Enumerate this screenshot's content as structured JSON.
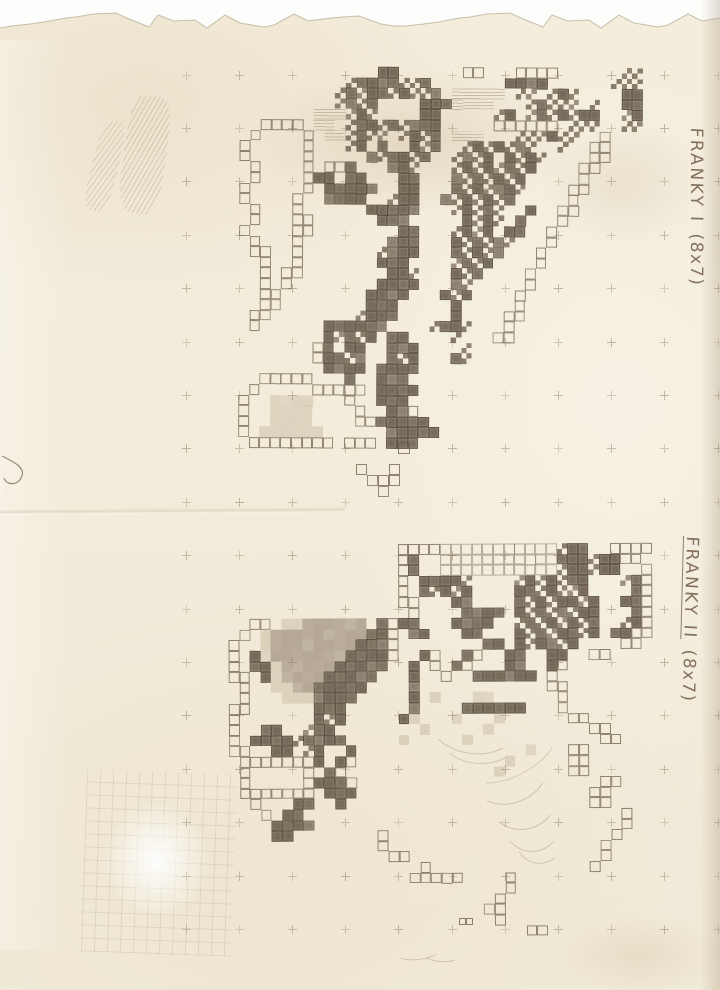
{
  "labels": {
    "franky1": {
      "text_name": "FRANKY I",
      "text_size": "(8x7)",
      "underlined": false
    },
    "franky2": {
      "text_name": "FRANKY II",
      "text_size": "(8x7)",
      "underlined": true
    }
  },
  "palette": {
    "paper": "#f3ecda",
    "pencil_dark": "#5a4d3d",
    "pencil_mid": "#8a7a66",
    "pencil_light": "#b8a88f",
    "grid_cross": "#9a8c74",
    "background": "#fdfdfb"
  },
  "grid": {
    "x0": 186,
    "y0": 75,
    "dx": 53.2,
    "dy": 53.4,
    "cols": 11,
    "rows": 17
  },
  "sprites": [
    {
      "id": "franky1",
      "x": 240,
      "y": 66,
      "cell": 10.6,
      "rows": [
        ".............##......oo...oooo......**..",
        "..........*####**#.......####......***..",
        ".........*#*##*#**#.hhhhh.**.*#*....##..",
        ".........*#*#....###hhhh...*#***.*..##..",
        ".......hhh*#*....##.....*#.*#*#*##..*#..",
        "..oooo.hh.*##*#*###.....oooooo.***..**..",
        ".o....o.hh*#**.*#*#.hhh...***#**..o.....",
        "o.....o...*#.#..#*#..*#*#*#*..*..oo.....",
        "o.....o.....#*##*#..*#*#.#*#*....oo.....",
        ".o....o.oo#...##*...*#*#*#*#....oo......",
        ".o....o##.##...##...#*#*#*#.....o.......",
        "o.....o.#####..##...#*#*##*....oo.......",
        "o....o..####..*##..#*#*#*#.....o........",
        ".o...o......#####...*#*#*..#..oo........",
        ".o...oo......###.....#*#*.#...o.........",
        "o....oo........##...*#*#.##..o..........",
        ".o...o........###...#*#*#*...o..........",
        ".oo..o.......*###...#*#*#...o...........",
        "..o..o.......###....*#*#....o...........",
        "..o.oo........##*...#*#....o............",
        "..o.o........####...#*.....o............",
        "..oo........####...#*#....o.............",
        "..oo........###.....#.....o.............",
        ".oo........*###.....#....oo.............",
        ".o......######....*##*...o..............",
        "........#*#*#.##....*...oo..............",
        ".......o#.##..###....*..................",
        ".......o##*#..#*#...#*..................",
        "........####.####.......................",
        "..ooooo...#..###........................",
        ".o.....ooooo.####.......................",
        "o..ssss...o..###........................",
        "o..ssss....o..##o.......................",
        "o..ssss....oo#####......................",
        "o.ssssss......#####.....................",
        ".oooooooo.ooo.###......................."
      ]
    },
    {
      "id": "franky2",
      "x": 228,
      "y": 545,
      "cell": 10.6,
      "rows": [
        "................ooooxxxxxxxxxxx*##..oooo",
        "................o#..xxxxxxxxxxx###*##oo.",
        "................o#..xxxxxxxxxxx*##*##..o",
        "................o.####*....*#*#*##...*#o",
        "................o.#*#*#....##*#**#....#o",
        "................oo...##....#*#*##*#..##o",
        ".................o....####.#*#*#*##...#o",
        "..oo.ssSSSSSS.#o##...####..*#*#*#*#..*#o",
        ".o.sSSSSSSSSS##o.##...##...#*#*##*#.##oo",
        "o..sSSSSSSSS###o........##.#*##*#....oo.",
        "o.#sSSSSSSS####o..#o..#o..##..##..oo....",
        "o.##sSSSSS#####..#.o.#o...##..#o........",
        "oo.#sSSSS#####...#..o..######.o.........",
        ".o..ssSS#####....#............oo........",
        ".o...sss####.....#.s...ss......o........",
        "oo......###......#....######...o........",
        "o.......#*#.....#s...s...s......oo......",
        "o..##..*##........s.....s.........oo....",
        "o.####*####.....s.....s............oo...",
        "oo..##.*#..#................s...oo......",
        ".ooooooo#.#o..............s.....oo......",
        ".o.....o.#o..............s......oo......",
        ".o.....o###o.......................oo...",
        ".ooooooo.###......................oo....",
        "..o...##..#.......................oo....",
        "...o.##..............................o..",
        "....####.............................o..",
        "....##........o.....................o...",
        "..............o....................o....",
        "...............oo..................o....",
        "..................o...............o.....",
        ".................ooooo....o.............",
        "..........................o.............",
        ".........................o..............",
        "........................oo..............",
        ".........................o..............",
        "............................oo.........."
      ]
    },
    {
      "id": "doodle",
      "x": 356,
      "y": 464,
      "cell": 11,
      "rows": [
        "o..o",
        ".ooo",
        "..o."
      ]
    },
    {
      "id": "box1",
      "x": 459,
      "y": 918,
      "cell": 7,
      "rows": [
        "oo"
      ]
    },
    {
      "id": "box2",
      "x": 398,
      "y": 442,
      "cell": 12,
      "rows": [
        "o"
      ]
    }
  ],
  "shading": {
    "arcs": [
      {
        "x": 452,
        "y": 96,
        "w": 64,
        "h": 84,
        "rot": -14,
        "o": 0.3
      },
      {
        "x": 462,
        "y": 118,
        "w": 52,
        "h": 70,
        "rot": -8,
        "o": 0.28
      },
      {
        "x": 430,
        "y": 698,
        "w": 84,
        "h": 54,
        "rot": 8,
        "o": 0.3
      },
      {
        "x": 442,
        "y": 718,
        "w": 72,
        "h": 44,
        "rot": 4,
        "o": 0.28
      },
      {
        "x": 468,
        "y": 738,
        "w": 78,
        "h": 64,
        "rot": -18,
        "o": 0.32
      },
      {
        "x": 484,
        "y": 756,
        "w": 72,
        "h": 72,
        "rot": -8,
        "o": 0.3
      },
      {
        "x": 500,
        "y": 778,
        "w": 62,
        "h": 72,
        "rot": 0,
        "o": 0.3
      },
      {
        "x": 514,
        "y": 800,
        "w": 52,
        "h": 62,
        "rot": 10,
        "o": 0.28
      },
      {
        "x": 466,
        "y": 732,
        "w": 92,
        "h": 42,
        "rot": -28,
        "o": 0.25
      },
      {
        "x": 396,
        "y": 944,
        "w": 42,
        "h": 14,
        "rot": -6,
        "o": 0.3
      },
      {
        "x": 424,
        "y": 950,
        "w": 32,
        "h": 10,
        "rot": 4,
        "o": 0.3
      }
    ],
    "scribbles": [
      {
        "x": 92,
        "y": 120,
        "w": 26,
        "h": 92,
        "rot": 14,
        "o": 0.45
      },
      {
        "x": 124,
        "y": 96,
        "w": 42,
        "h": 118,
        "rot": 8,
        "o": 0.5
      }
    ]
  }
}
